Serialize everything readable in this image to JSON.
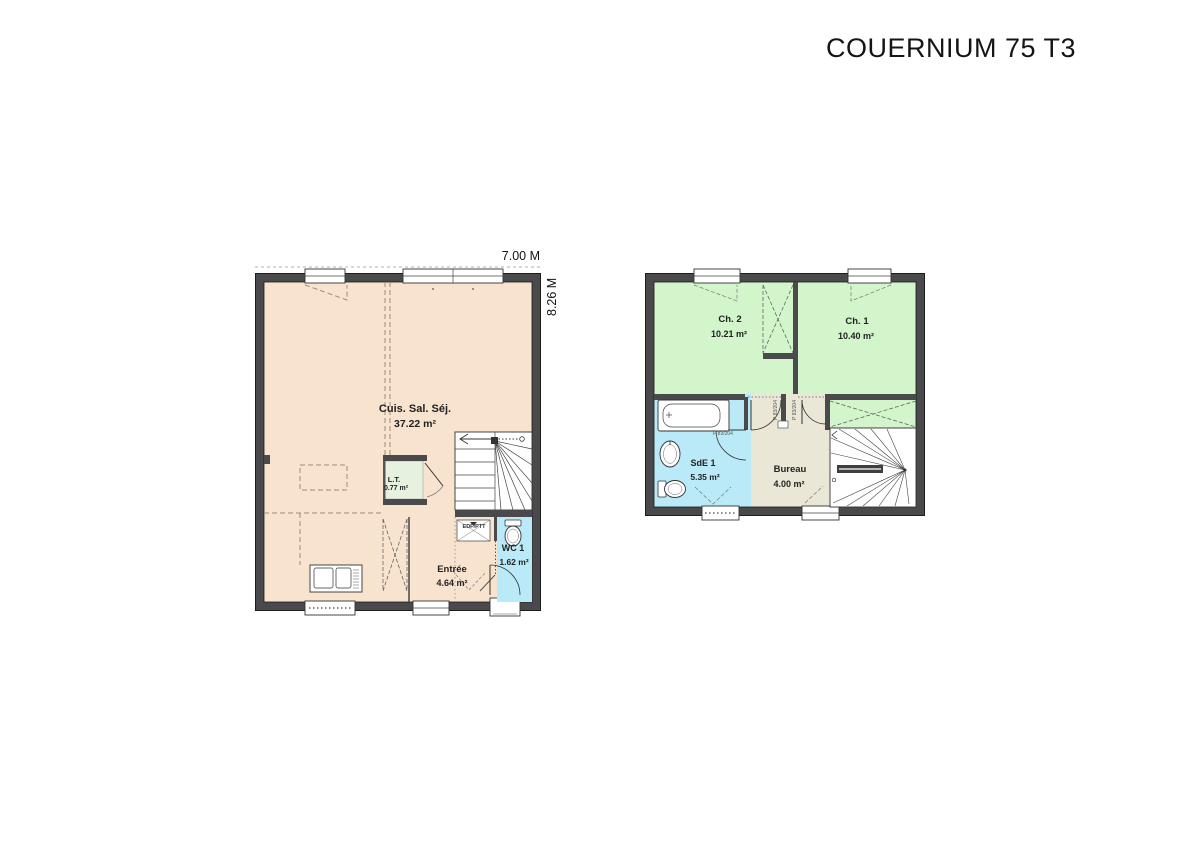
{
  "title": "COUERNIUM 75 T3",
  "palette": {
    "wall": "#4a4a4c",
    "living_fill": "#f8e3cf",
    "bedroom_fill": "#d2f5cb",
    "bath_fill": "#baeaf8",
    "bureau_fill": "#eae7d7",
    "lt_fill": "#e7f1df"
  },
  "ground_floor": {
    "dim_width": "7.00 M",
    "dim_height": "8.26 M",
    "living": {
      "name": "Cuis. Sal. Séj.",
      "area": "37.22 m²"
    },
    "lt": {
      "name": "L.T.",
      "area": "0.77 m²"
    },
    "entree": {
      "name": "Entrée",
      "area": "4.64 m²"
    },
    "wc": {
      "name": "WC 1",
      "area": "1.62 m²"
    },
    "utility_label": "EDF/PTT"
  },
  "upper_floor": {
    "ch2": {
      "name": "Ch. 2",
      "area": "10.21 m²"
    },
    "ch1": {
      "name": "Ch. 1",
      "area": "10.40 m²"
    },
    "sde": {
      "name": "SdE 1",
      "area": "5.35 m²"
    },
    "bureau": {
      "name": "Bureau",
      "area": "4.00 m²"
    },
    "door_label": "P 83/204"
  }
}
